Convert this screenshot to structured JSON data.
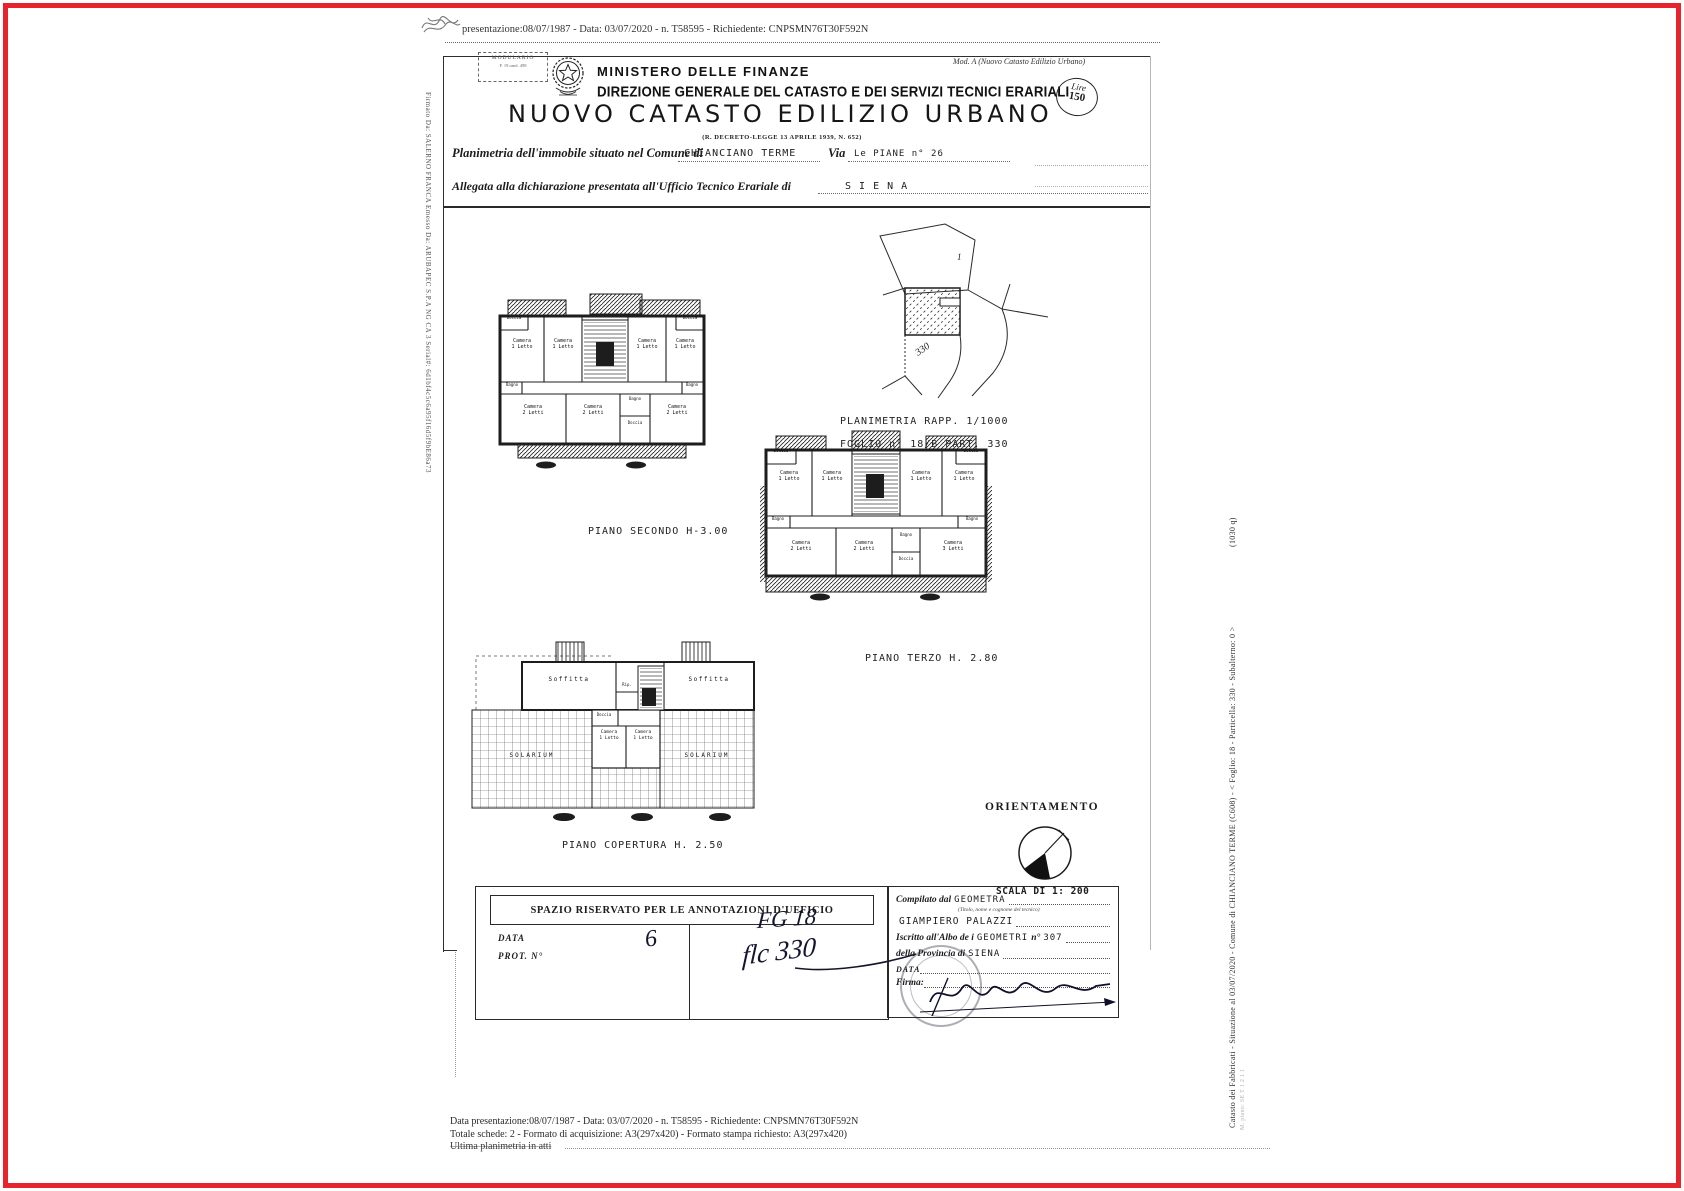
{
  "page": {
    "meta_line": "presentazione:08/07/1987 - Data: 03/07/2020 - n. T58595 - Richiedente: CNPSMN76T30F592N"
  },
  "header": {
    "modulario_line1": "MODULARIO",
    "modulario_line2": "F. 19 rand. 498",
    "ministry": "MINISTERO DELLE FINANZE",
    "direzione": "DIREZIONE GENERALE DEL CATASTO E DEI SERVIZI TECNICI ERARIALI",
    "mod_a": "Mod. A (Nuovo Catasto Edilizio Urbano)",
    "title": "NUOVO CATASTO EDILIZIO URBANO",
    "law": "(R. DECRETO-LEGGE 13 APRILE 1939, N. 652)",
    "stamp_lire": "Lire",
    "stamp_value": "150"
  },
  "form": {
    "comune_label": "Planimetria dell'immobile situato nel Comune di",
    "comune_value": "CHIANCIANO TERME",
    "via_label": "Via",
    "via_value": "Le PIANE n° 26",
    "ufficio_label": "Allegata alla dichiarazione presentata all'Ufficio Tecnico Erariale di",
    "ufficio_value": "S I E N A"
  },
  "map": {
    "caption_rapp": "PLANIMETRIA RAPP. 1/1000",
    "caption_foglio": "FOGLIO n° 18/B  PART. 330",
    "parcel_top": "1",
    "parcel_num": "330"
  },
  "plans": {
    "secondo": {
      "caption": "PIANO SECONDO  H-3.00",
      "rooms": [
        "Doccia",
        "Camera\n1 Letto",
        "Camera\n1 Letto",
        "Camera\n1 Letto",
        "Camera\n1 Letto",
        "Doccia",
        "Bagno",
        "Bagno",
        "Camera\n2 Letti",
        "Camera\n2 Letti",
        "Bagno",
        "Doccia",
        "Camera\n2 Letti"
      ]
    },
    "terzo": {
      "caption": "PIANO TERZO H. 2.80",
      "rooms": [
        "Doccia",
        "Camera\n1 Letto",
        "Camera\n1 Letto",
        "Camera\n1 Letto",
        "Camera\n1 Letto",
        "Doccia",
        "Bagno",
        "Bagno",
        "Camera\n2 Letti",
        "Camera\n2 Letti",
        "Bagno",
        "Doccia",
        "Camera\n3 Letti"
      ]
    },
    "copertura": {
      "caption": "PIANO COPERTURA H. 2.50",
      "rooms": [
        "Soffitta",
        "Rip.",
        "Soffitta",
        "Doccia",
        "Camera\n1 Letto",
        "Camera\n1 Letto",
        "SOLARIUM",
        "SOLARIUM"
      ]
    }
  },
  "orientation": {
    "label": "ORIENTAMENTO",
    "scale": "SCALA DI 1: 200"
  },
  "office_box": {
    "title": "SPAZIO RISERVATO PER LE ANNOTAZIONI D'UFFICIO",
    "data_label": "DATA",
    "prot_label": "PROT. N°",
    "hand_note": "6",
    "hand_fg": "FG 18",
    "hand_part": "flc 330"
  },
  "compiler_box": {
    "compilato_label": "Compilato dal",
    "compilato_value": "GEOMETRA",
    "compilato_sub": "(Titolo, nome e cognome del tecnico)",
    "name_value": "GIAMPIERO PALAZZI",
    "albo_label": "Iscritto all'Albo de i",
    "albo_value": "GEOMETRI",
    "albo_n_label": "n°",
    "albo_n_value": "307",
    "provincia_label": "della Provincia di",
    "provincia_value": "SIENA",
    "data_label": "DATA",
    "firma_label": "Firma:"
  },
  "footer": {
    "line1": "Data presentazione:08/07/1987 - Data: 03/07/2020 - n. T58595 - Richiedente: CNPSMN76T30F592N",
    "line2": "Totale schede: 2 - Formato di acquisizione: A3(297x420)  - Formato stampa richiesto: A3(297x420)",
    "line3": "Ultima planimetria in atti"
  },
  "sidebars": {
    "left": "Firmato Da: SALERNO FRANCA Emesso Da: ARUBAPEC S.P.A NG CA 3 Serial#: 6d1bf4c5c6a95f16d5f9bE86a73",
    "right_main": "Catasto dei Fabbricati - Situazione al 03/07/2020 - Comune di CHIANCIANO TERME (C608) - < Foglio: 18 - Particella: 330 - Subalterno: 0 >",
    "right_extra": "(1030 q)",
    "right_secondary": "M. piano: SE T 1 2 1 1"
  },
  "colors": {
    "frame_red": "#e5242b",
    "ink": "#1d1d1d"
  }
}
